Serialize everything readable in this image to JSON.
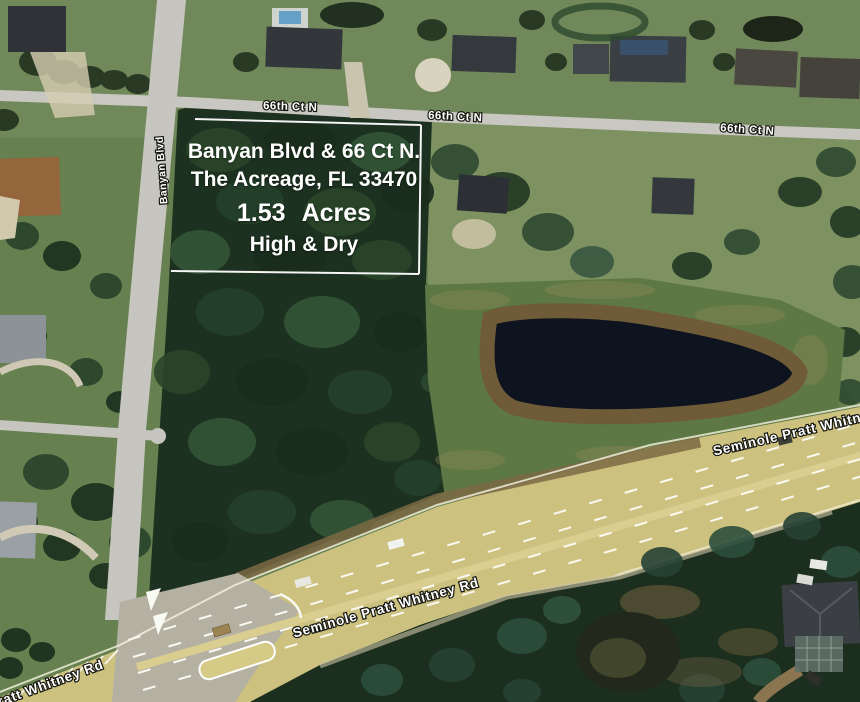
{
  "listing_overlay": {
    "line1": "Banyan Blvd & 66 Ct N.",
    "line2": "The Acreage, FL 33470",
    "line3": "1.53 Acres",
    "line4": "High & Dry"
  },
  "road_labels": {
    "street_66_ct_n": "66th Ct N",
    "banyan_blvd": "Banyan Blvd",
    "seminole_pratt_whitney_rd": "Seminole Pratt Whitney Rd"
  },
  "colors": {
    "overlay_text": "#ffffff",
    "parcel_boundary": "#ffffff",
    "highway_surface": "#cdc17f",
    "highway_apron": "#b4b1a3",
    "local_road_surface": "#c8c7c1",
    "woods_dark_green": "#1d3120",
    "grass_green": "#66804f",
    "pond_water": "#0d1420",
    "pond_bank": "#6f5b38",
    "dirt_brown": "#7b6844"
  }
}
